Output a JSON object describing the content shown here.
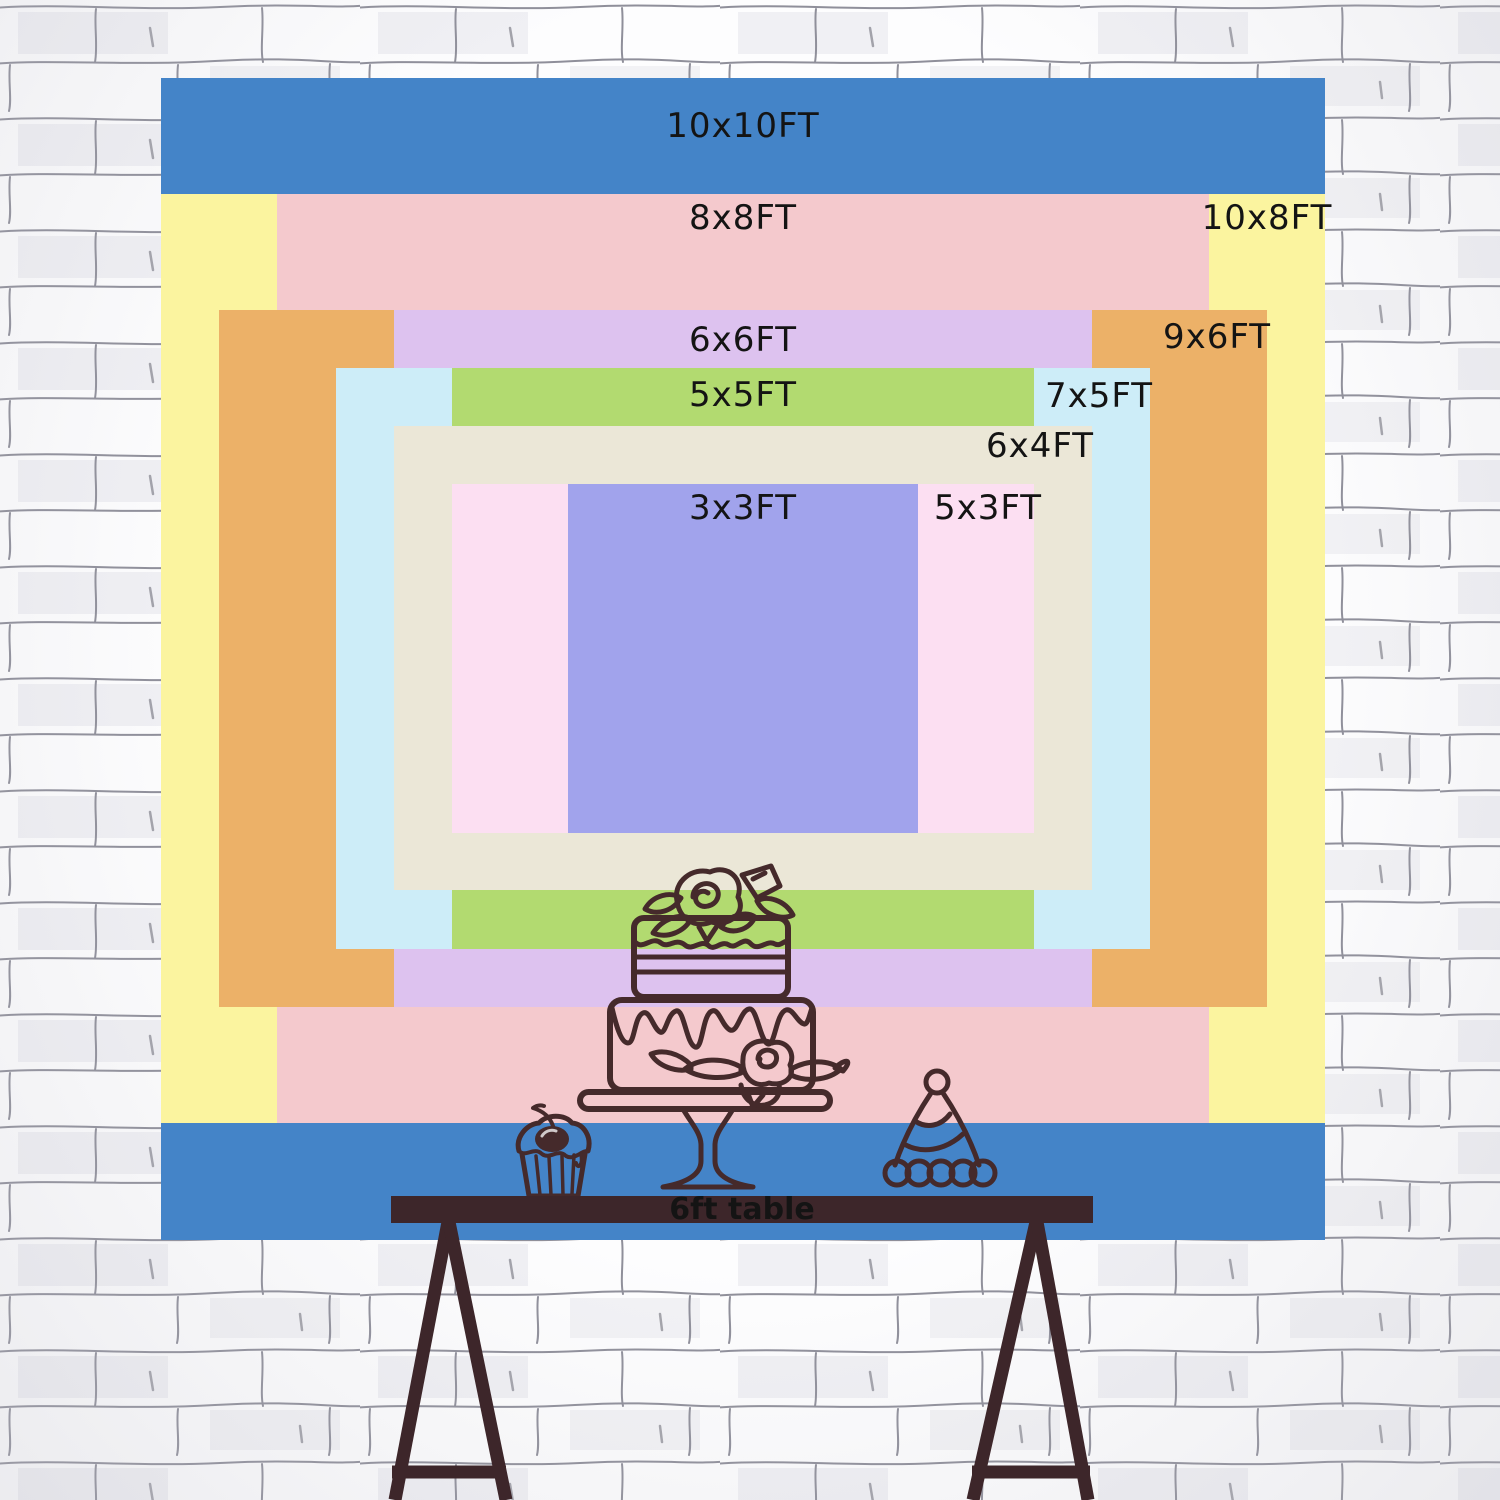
{
  "theme": {
    "line": "#452a2b",
    "table": "#3d262a",
    "text": "#141414"
  },
  "backdrop": {
    "layers": [
      {
        "size": "10x10FT",
        "color": "#4484c8"
      },
      {
        "size": "10x8FT",
        "color": "#fbf49f"
      },
      {
        "size": "8x8FT",
        "color": "#f4c9cd"
      },
      {
        "size": "9x6FT",
        "color": "#ecb168"
      },
      {
        "size": "6x6FT",
        "color": "#ddc2ef"
      },
      {
        "size": "7x5FT",
        "color": "#cdedf8"
      },
      {
        "size": "5x5FT",
        "color": "#b2da70"
      },
      {
        "size": "6x4FT",
        "color": "#ebe7d7"
      },
      {
        "size": "5x3FT",
        "color": "#fcdff2"
      },
      {
        "size": "3x3FT",
        "color": "#a1a3ec"
      }
    ]
  },
  "table": {
    "label": "6ft table",
    "color": "#3d262a"
  },
  "illustrations": {
    "cake": "two-tier-cake-on-stand",
    "cupcake": "cupcake-with-cherry",
    "hat": "party-hat",
    "wall": "white-brick-wall"
  }
}
